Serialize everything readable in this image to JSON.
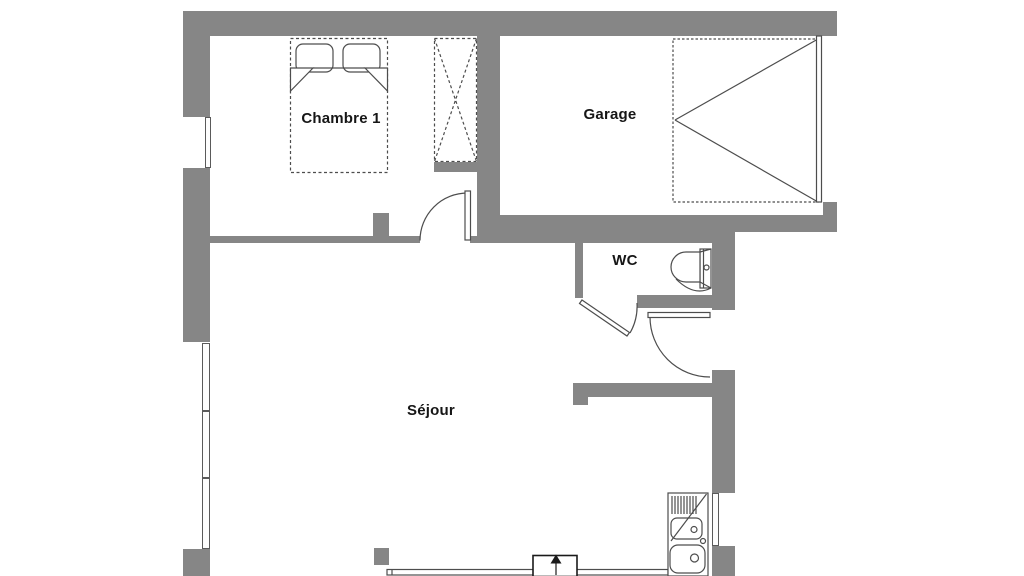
{
  "plan": {
    "type": "floor-plan",
    "rooms": {
      "chambre": {
        "label": "Chambre 1"
      },
      "garage": {
        "label": "Garage"
      },
      "wc": {
        "label": "WC"
      },
      "sejour": {
        "label": "Séjour"
      }
    },
    "symbols": [
      "double-bed-with-pillows",
      "wardrobe-cross",
      "garage-door-swing",
      "interior-door-swing-chambre",
      "interior-door-swing-wc",
      "entrance-door-swing",
      "toilet",
      "kitchen-double-sink-with-drainer",
      "entry-direction-arrow",
      "windows"
    ]
  },
  "colors": {
    "wall": "#868686",
    "line": "#4d4d4d",
    "text": "#161616",
    "background": "#ffffff"
  }
}
